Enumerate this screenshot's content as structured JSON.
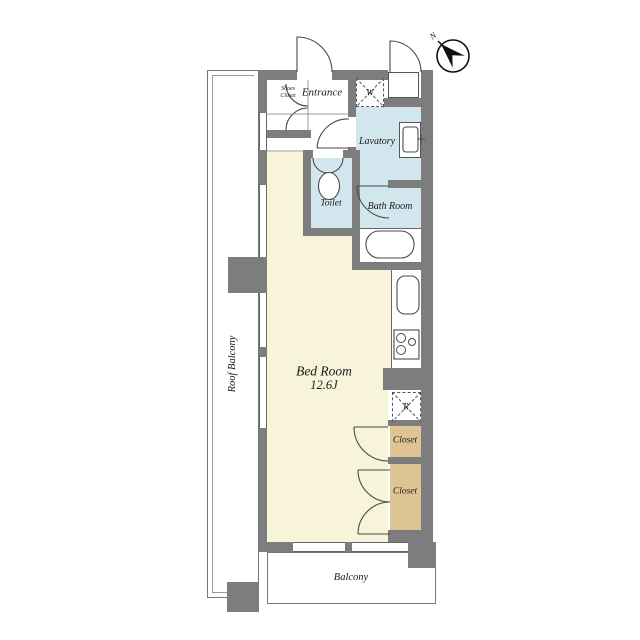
{
  "colors": {
    "wall": "#7d7d7d",
    "wet_room": "#d2e6ee",
    "bedroom": "#f8f4da",
    "closet": "#dfc493"
  },
  "rooms": {
    "entrance": {
      "label": "Entrance"
    },
    "shoes_closet": {
      "label_line1": "Shoes",
      "label_line2": "Closet"
    },
    "lavatory": {
      "label": "Lavatory"
    },
    "toilet": {
      "label": "Toilet"
    },
    "bath_room": {
      "label": "Bath Room"
    },
    "bed_room": {
      "label": "Bed Room",
      "size": "12.6J"
    },
    "closet_upper": {
      "label": "Closet"
    },
    "closet_lower": {
      "label": "Closet"
    },
    "balcony": {
      "label": "Balcony"
    },
    "roof_balcony": {
      "label": "Roof Balcony"
    }
  },
  "appliances": {
    "washing_machine_label": "W",
    "refrigerator_label": "R"
  },
  "compass": {
    "north_label": "N"
  }
}
